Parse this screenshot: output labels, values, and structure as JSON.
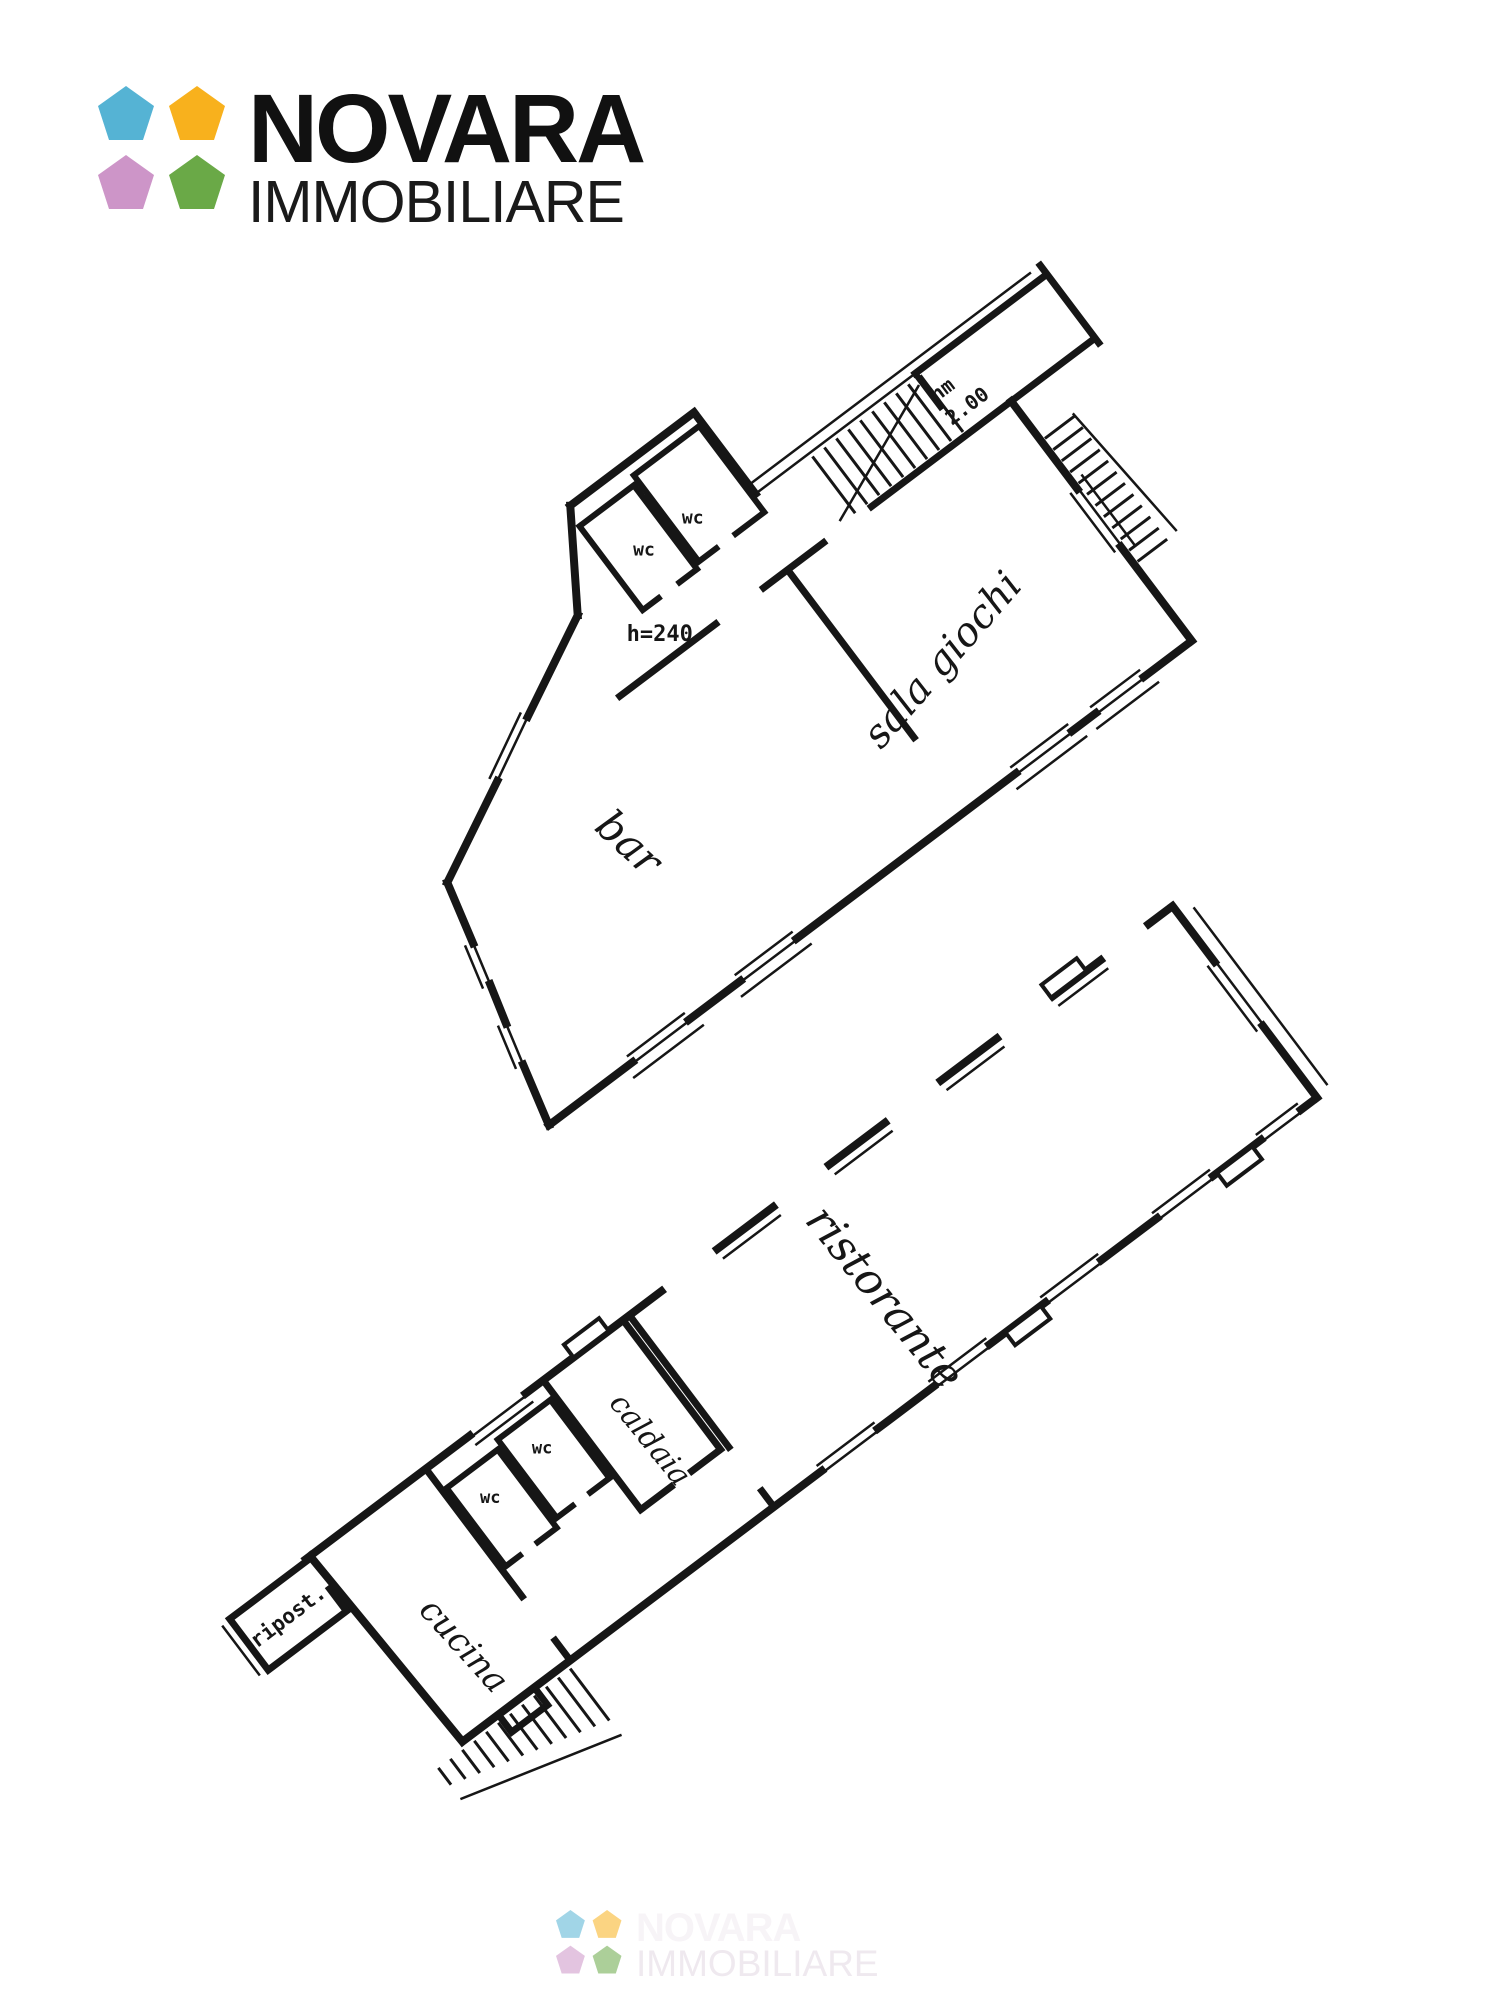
{
  "brand": {
    "title": "NOVARA",
    "subtitle": "IMMOBILIARE",
    "pentagon_colors": {
      "blue": "#55b3d4",
      "yellow": "#f8b11d",
      "pink": "#cd95c8",
      "green": "#6aa947"
    }
  },
  "floor_plans": {
    "upper": {
      "labels": {
        "bar": "bar",
        "sala_giochi": "sala giochi",
        "wc_left": "wc",
        "wc_right": "wc",
        "height_note": "h=240",
        "mezzanine_line1": "hm",
        "mezzanine_line2": "2.00"
      }
    },
    "lower": {
      "labels": {
        "ristorante": "ristorante",
        "caldaia": "caldaia",
        "wc_left": "wc",
        "wc_right": "wc",
        "ripostiglio": "ripost.",
        "cucina": "cucina"
      }
    }
  },
  "watermark": {
    "title": "NOVARA",
    "subtitle": "IMMOBILIARE"
  }
}
